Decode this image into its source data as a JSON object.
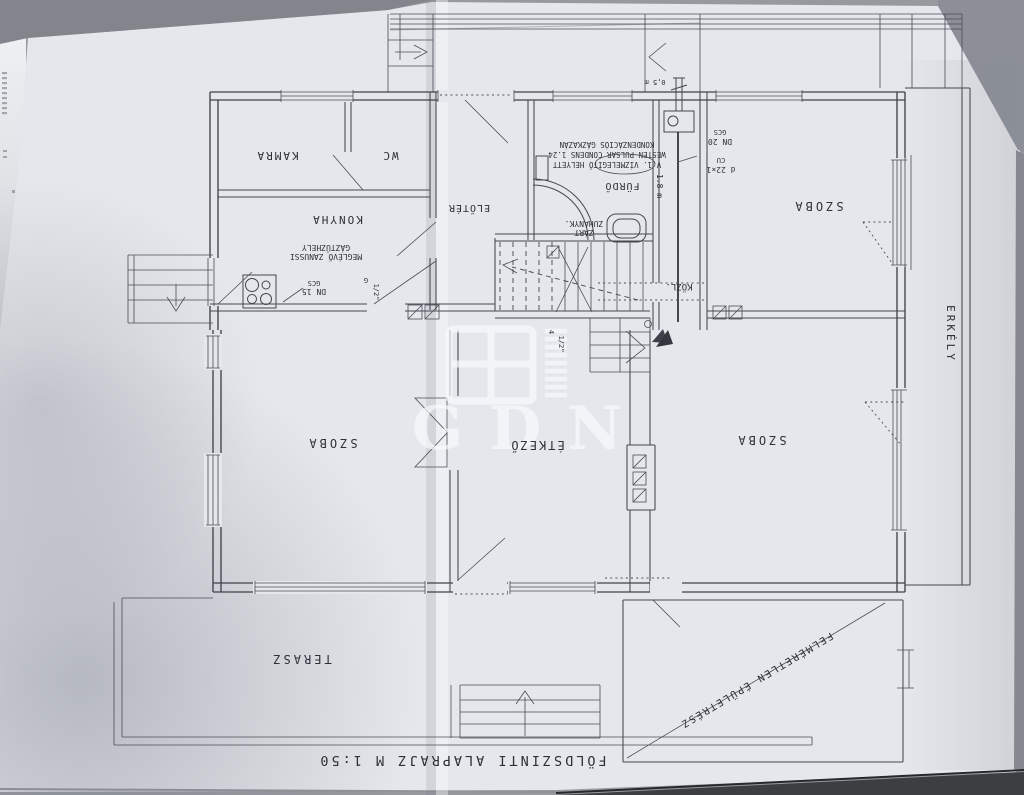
{
  "scene": {
    "background_color": "#97999e",
    "paper_color": "#e6e7ec",
    "line_color": "#3f424a",
    "text_color": "#2d3038"
  },
  "watermark": {
    "text": "GDN"
  },
  "title": {
    "text": "FÖLDSZINTI  ALAPRAJZ   M 1:50"
  },
  "rooms": {
    "kamra": "KAMRA",
    "wc": "WC",
    "konyha": "KONYHA",
    "eloter": "ELŐTÉR",
    "furdo": "FÜRDŐ",
    "zuhany1": "ZÁRT",
    "zuhany2": "ZUHANYK.",
    "kozl": "KÖZL.",
    "szoba_top": "SZOBA",
    "szoba_left": "SZOBA",
    "etkezo": "ÉTKEZŐ",
    "szoba_bottom": "SZOBA",
    "terasz": "TERASZ",
    "erkely": "ERKÉLY",
    "felmeretlen": "FELMÉRETLEN  ÉPÜLETRÉSZ"
  },
  "annotations": {
    "stove1": "MEGLÉVŐ ZANUSSI",
    "stove2": "GÁZTŰZHELY",
    "dn15": "DN 15",
    "gcs_small": "GCS",
    "dn20": "DN 20",
    "gcs_small2": "GCS",
    "pipe_dim": "d 22×1",
    "pipe_mat": "CU",
    "boiler1": "V.1. VÍZMELEGÍTŐ HELYETT",
    "boiler2": "WESTEN PULSAR CONDENS 1.24",
    "boiler3": "KONDENZÁCIÓS GÁZKAZÁN",
    "len18": "1.8 m",
    "len05": "0,5 m",
    "g": "G",
    "half1": "1/2\"",
    "half2": "1/2\"",
    "four": "4"
  }
}
